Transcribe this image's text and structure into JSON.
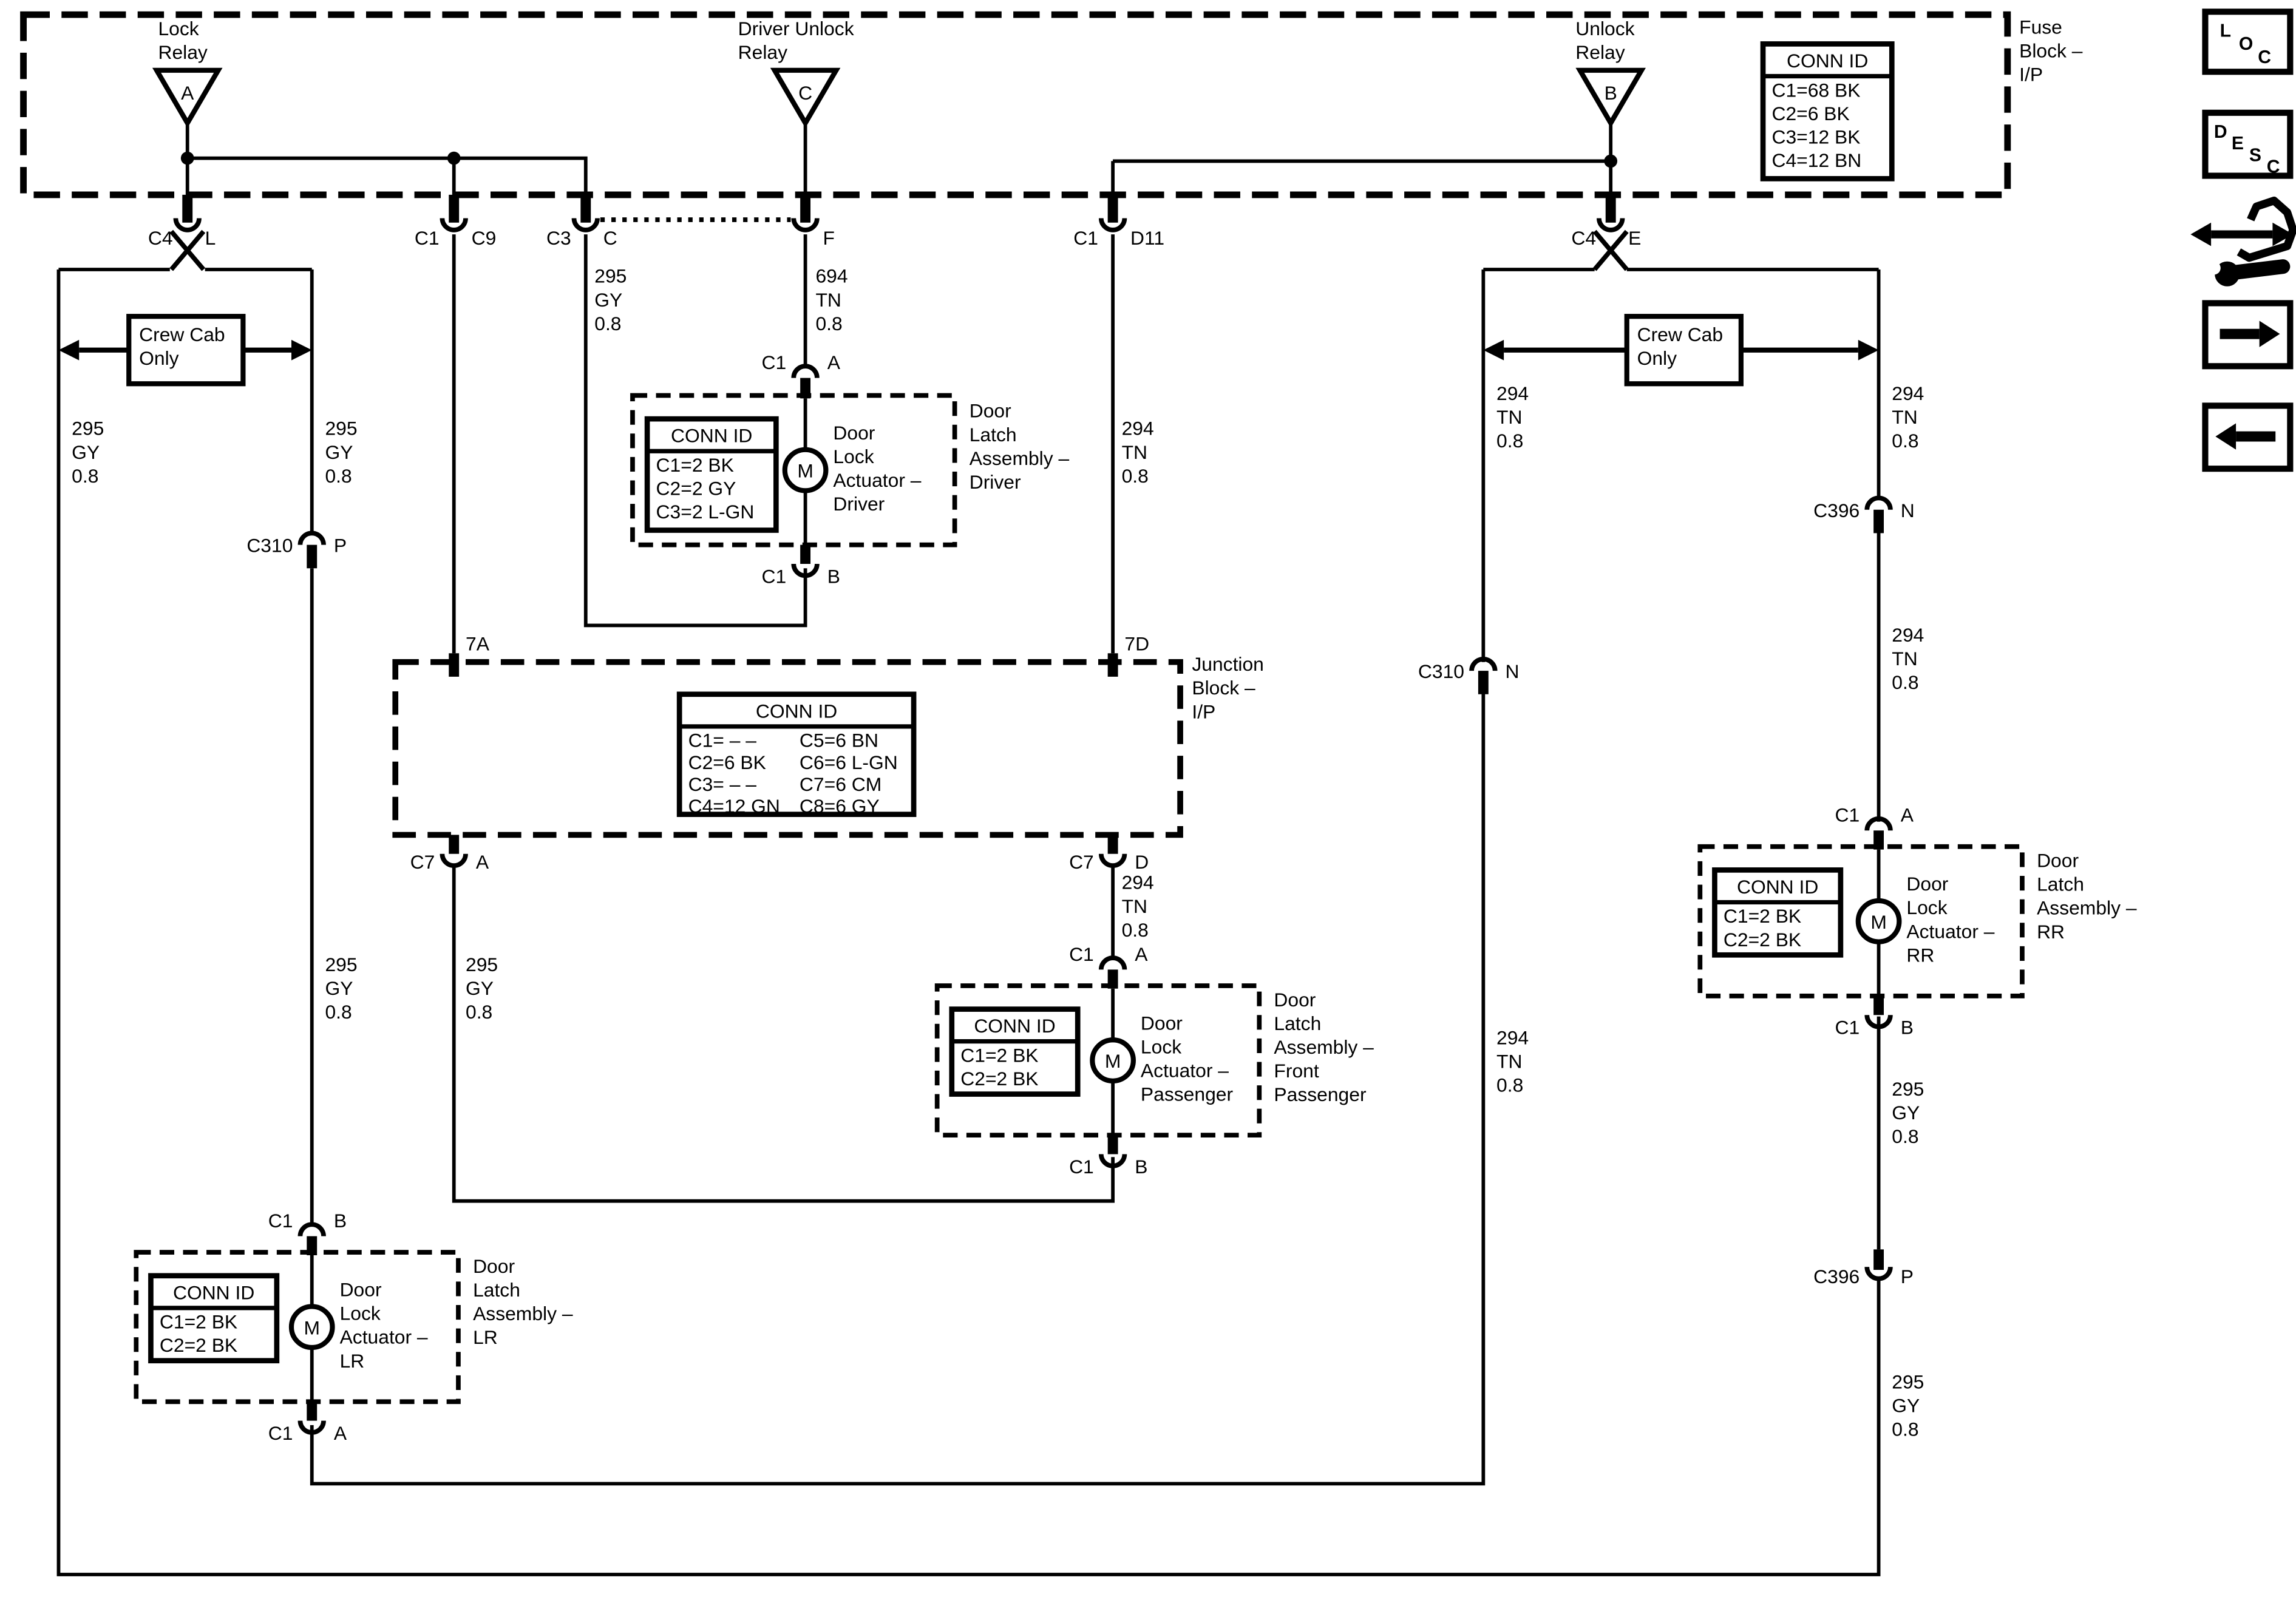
{
  "colors": {
    "background": "#ffffff",
    "ink": "#000000"
  },
  "side_toolbar": {
    "loc_letters": [
      "L",
      "O",
      "C"
    ],
    "desc_letters": [
      "D",
      "E",
      "S",
      "C"
    ]
  },
  "fuse_block": {
    "label": "Fuse\nBlock –\nI/P",
    "conn_id": {
      "title": "CONN ID",
      "rows": [
        "C1=68 BK",
        "C2=6 BK",
        "C3=12 BK",
        "C4=12 BN"
      ]
    },
    "relays": {
      "lock": {
        "label": "Lock\nRelay",
        "pin": "A"
      },
      "driver_unlock": {
        "label": "Driver Unlock\nRelay",
        "pin": "C"
      },
      "unlock": {
        "label": "Unlock\nRelay",
        "pin": "B"
      }
    },
    "connectors": {
      "c4_l": {
        "name": "C4",
        "pin": "L"
      },
      "c1_c9": {
        "name": "C1",
        "pin": "C9"
      },
      "c3_c": {
        "name": "C3",
        "pin": "C"
      },
      "f": {
        "pin": "F"
      },
      "c1_d11": {
        "name": "C1",
        "pin": "D11"
      },
      "c4_e": {
        "name": "C4",
        "pin": "E"
      }
    }
  },
  "junction_block": {
    "label": "Junction\nBlock –\nI/P",
    "entry_left": "7A",
    "entry_right": "7D",
    "conn_id": {
      "title": "CONN ID",
      "left_rows": [
        "C1= – –",
        "C2=6 BK",
        "C3= – –",
        "C4=12 GN"
      ],
      "right_rows": [
        "C5=6 BN",
        "C6=6 L-GN",
        "C7=6 CM",
        "C8=6 GY"
      ]
    },
    "exit_left": {
      "name": "C7",
      "pin": "A"
    },
    "exit_right": {
      "name": "C7",
      "pin": "D"
    }
  },
  "crew_cab": {
    "left_label": "Crew Cab\nOnly",
    "right_label": "Crew Cab\nOnly"
  },
  "inline_connectors": {
    "c310_p": {
      "name": "C310",
      "pin": "P"
    },
    "c310_n": {
      "name": "C310",
      "pin": "N"
    },
    "c396_n": {
      "name": "C396",
      "pin": "N"
    },
    "c396_p": {
      "name": "C396",
      "pin": "P"
    }
  },
  "wire_labels": {
    "left_outer": "295\nGY\n0.8",
    "left_inner_upper": "295\nGY\n0.8",
    "left_inner_mid": "295\nGY\n0.8",
    "c9_mid": "295\nGY\n0.8",
    "c3_upper": "295\nGY\n0.8",
    "driver_feed": "694\nTN\n0.8",
    "d11_upper": "294\nTN\n0.8",
    "d11_mid": "294\nTN\n0.8",
    "unlock_inner_upper": "294\nTN\n0.8",
    "unlock_inner_lower": "294\nTN\n0.8",
    "unlock_outer_upper": "294\nTN\n0.8",
    "unlock_outer_mid": "294\nTN\n0.8",
    "rr_lower": "295\nGY\n0.8",
    "rr_bottom": "295\nGY\n0.8"
  },
  "actuators": {
    "driver": {
      "outer_label": "Door\nLatch\nAssembly –\nDriver",
      "inner_label": "Door\nLock\nActuator –\nDriver",
      "motor": "M",
      "conn_id": {
        "title": "CONN ID",
        "rows": [
          "C1=2 BK",
          "C2=2 GY",
          "C3=2 L-GN"
        ]
      },
      "pin_top": {
        "name": "C1",
        "pin": "A"
      },
      "pin_bottom": {
        "name": "C1",
        "pin": "B"
      }
    },
    "front_passenger": {
      "outer_label": "Door\nLatch\nAssembly –\nFront\nPassenger",
      "inner_label": "Door\nLock\nActuator –\nPassenger",
      "motor": "M",
      "conn_id": {
        "title": "CONN ID",
        "rows": [
          "C1=2 BK",
          "C2=2 BK"
        ]
      },
      "pin_top": {
        "name": "C1",
        "pin": "A"
      },
      "pin_bottom": {
        "name": "C1",
        "pin": "B"
      }
    },
    "lr": {
      "outer_label": "Door\nLatch\nAssembly –\nLR",
      "inner_label": "Door\nLock\nActuator –\nLR",
      "motor": "M",
      "conn_id": {
        "title": "CONN ID",
        "rows": [
          "C1=2 BK",
          "C2=2 BK"
        ]
      },
      "pin_top": {
        "name": "C1",
        "pin": "B"
      },
      "pin_bottom": {
        "name": "C1",
        "pin": "A"
      }
    },
    "rr": {
      "outer_label": "Door\nLatch\nAssembly –\nRR",
      "inner_label": "Door\nLock\nActuator –\nRR",
      "motor": "M",
      "conn_id": {
        "title": "CONN ID",
        "rows": [
          "C1=2 BK",
          "C2=2 BK"
        ]
      },
      "pin_top": {
        "name": "C1",
        "pin": "A"
      },
      "pin_bottom": {
        "name": "C1",
        "pin": "B"
      }
    }
  }
}
